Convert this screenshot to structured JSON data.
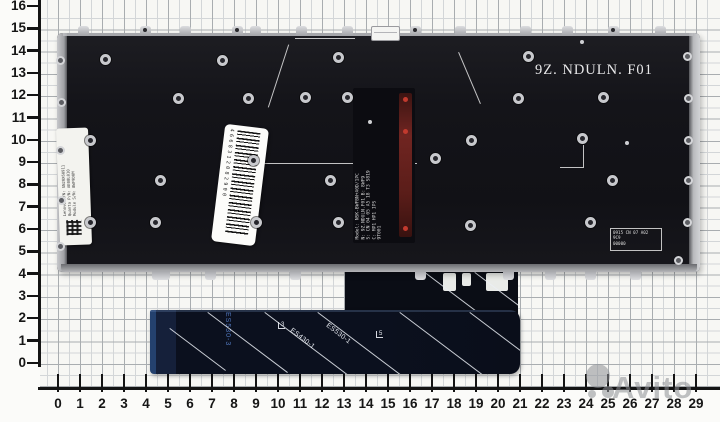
{
  "photo": {
    "subject": "laptop-keyboard-backplate-on-grid-paper",
    "colors": {
      "plate": "#141419",
      "metal": "#c8c9cd",
      "ribbon": "#0b101e",
      "ribbon_edge_blue": "#24416e",
      "copper_flex": "#702521",
      "grid_major": "#a9adb0",
      "grid_minor": "#d3d6d8",
      "ruler": "#141414",
      "watermark_gray": "#8e9195"
    }
  },
  "rulers": {
    "left": {
      "values": [
        "16",
        "15",
        "14",
        "13",
        "12",
        "11",
        "10",
        "9",
        "8",
        "7",
        "6",
        "5",
        "4",
        "3",
        "2",
        "1",
        "0"
      ]
    },
    "bottom": {
      "values": [
        "0",
        "1",
        "2",
        "3",
        "4",
        "5",
        "6",
        "7",
        "8",
        "9",
        "10",
        "11",
        "12",
        "13",
        "14",
        "15",
        "16",
        "17",
        "18",
        "19",
        "20",
        "21",
        "22",
        "23",
        "24",
        "25",
        "26",
        "27",
        "28",
        "29"
      ]
    }
  },
  "plate": {
    "model_text": "9Z. NDULN. F01"
  },
  "stickers": {
    "barcode": {
      "digits": "4668312082900"
    },
    "left_label": {
      "line1": "Lenovo P/N: SN20X60911",
      "line2": "Quanta P/N: AE08L010",
      "line3": "Module S/N: 8WF9D0M"
    },
    "flex_label": {
      "line1": "Model: NSK-BWFBN+A0D/1PC",
      "line2": "N: 9Z.NDULN.F01  B: 8WF9",
      "line3": "S: CN 04 05 A5 18 T3 S819",
      "line4": "C: MP1 HP1 IPS",
      "line5": "9T001"
    },
    "right_label": {
      "line1": "0915 CN 07 A02",
      "line2": "9C9",
      "line3": "00000"
    }
  },
  "ribbon": {
    "vertical_label": "ES530-3",
    "diag_label_1": "ES430-1",
    "diag_label_2": "ES530-1",
    "mark_1": "3",
    "mark_2": "5"
  },
  "watermark": {
    "text": "Avito"
  }
}
